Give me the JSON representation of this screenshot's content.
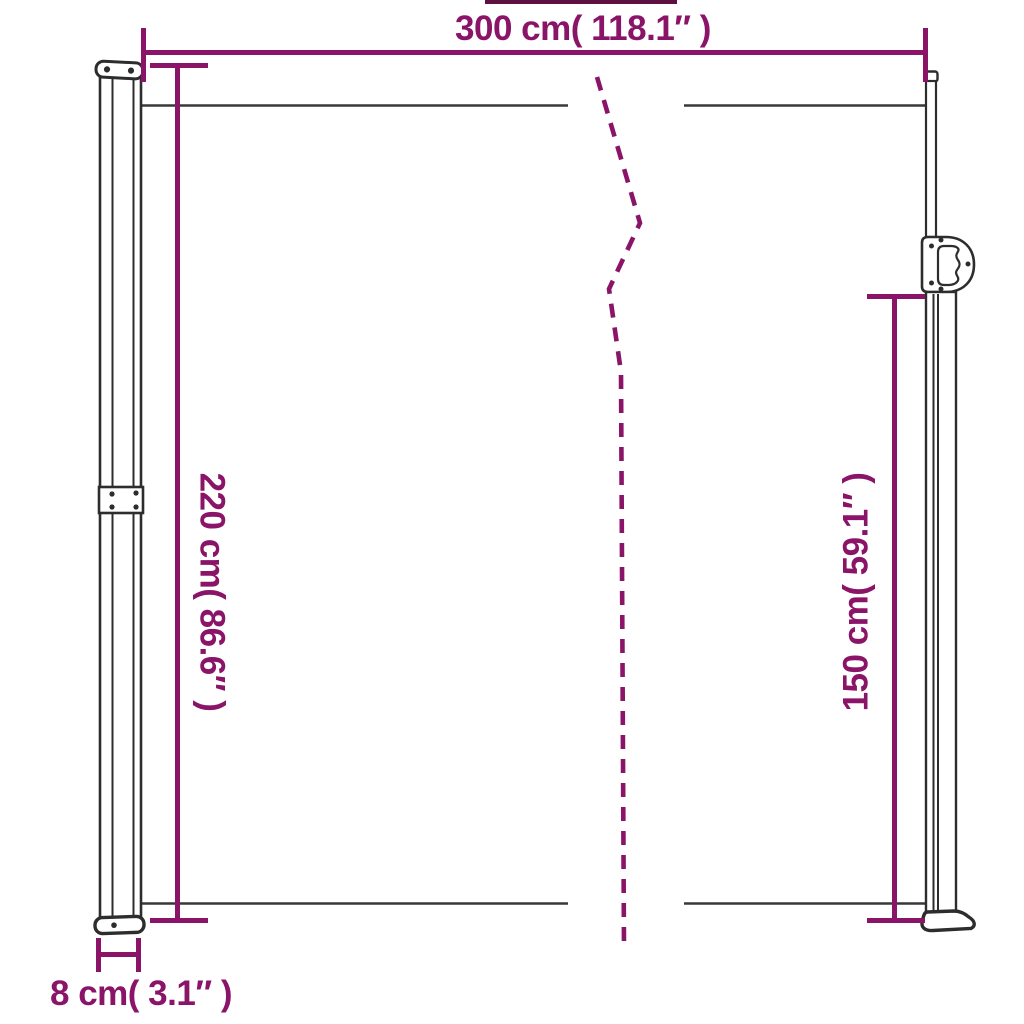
{
  "diagram": {
    "type": "product-dimension-diagram",
    "subject": "retractable side awning with two posts, fabric screen and break (fold) line",
    "colors": {
      "dimension_accent": "#8A1468",
      "structure_line": "#2D2D2D",
      "fabric_line": "#383838",
      "background": "#FFFFFF"
    },
    "dimensions": {
      "overall_width": {
        "cm": 300,
        "inches": 118.1,
        "label": "300 cm( 118.1″ )"
      },
      "overall_height": {
        "cm": 220,
        "inches": 86.6,
        "label": "220 cm( 86.6″ )"
      },
      "right_height": {
        "cm": 150,
        "inches": 59.1,
        "label": "150 cm( 59.1″ )"
      },
      "post_width": {
        "cm": 8,
        "inches": 3.1,
        "label": "8 cm( 3.1″ )"
      }
    }
  }
}
